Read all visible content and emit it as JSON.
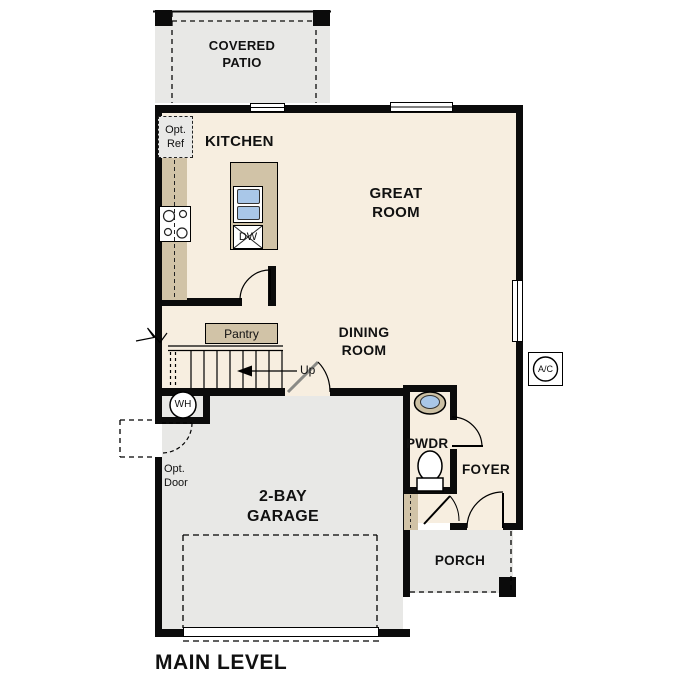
{
  "plan": {
    "title": "MAIN LEVEL",
    "rooms": {
      "covered_patio": "COVERED PATIO",
      "kitchen": "KITCHEN",
      "great_room": "GREAT ROOM",
      "dining_room": "DINING ROOM",
      "pantry": "Pantry",
      "garage": "2-BAY GARAGE",
      "powder": "PWDR",
      "foyer": "FOYER",
      "porch": "PORCH"
    },
    "labels": {
      "opt_ref": "Opt. Ref",
      "opt_door": "Opt. Door",
      "up": "Up",
      "water_heater": "WH",
      "ac_unit": "A/C",
      "dishwasher": "DW"
    },
    "colors": {
      "floor_interior": "#f7eee0",
      "floor_exterior": "#e8e8e6",
      "casework_tan": "#d1c3a7",
      "fixture_blue": "#a9c7e8",
      "wall_black": "#0b0b0b"
    }
  }
}
